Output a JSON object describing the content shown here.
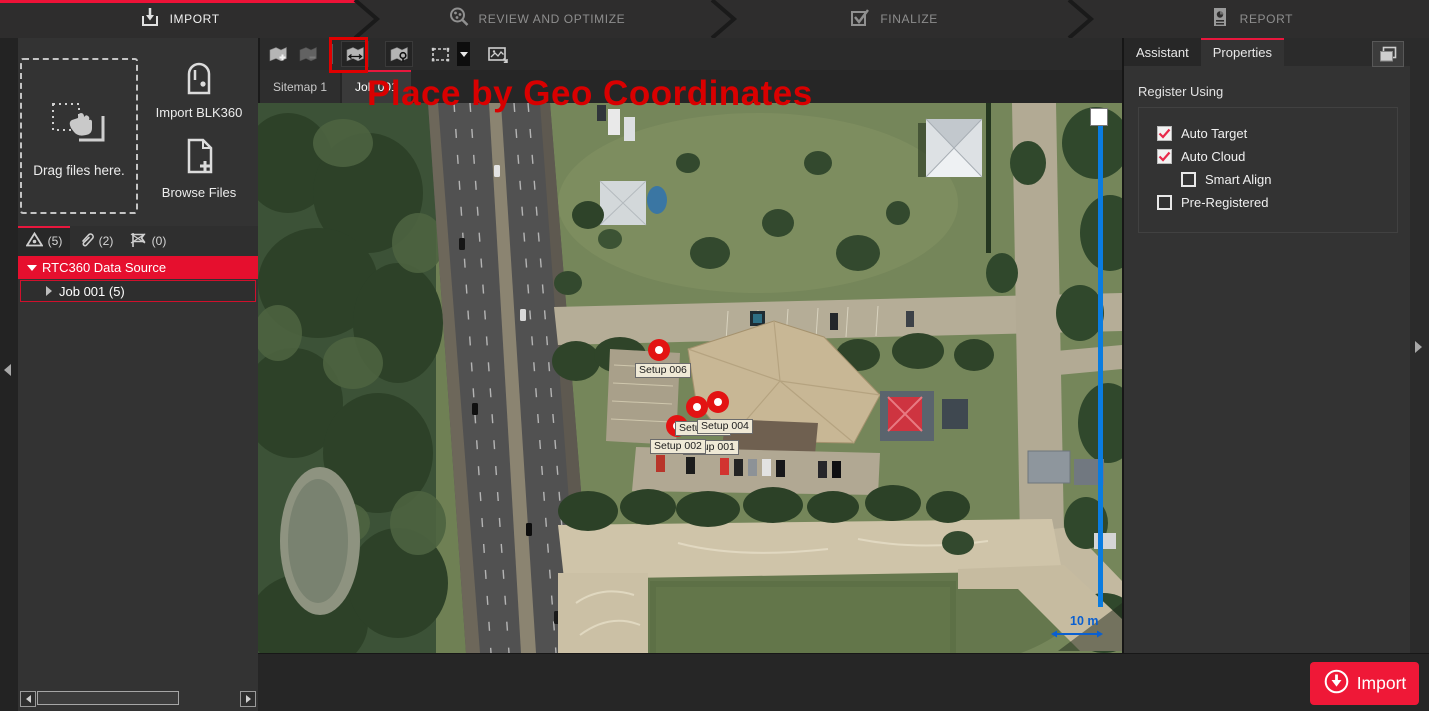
{
  "colors": {
    "accent_red": "#e8173d",
    "annotation_red": "#d90000",
    "slider_blue": "#0a7ce0",
    "tree_selected_red": "#e60f2e"
  },
  "workflow": {
    "steps": [
      {
        "label": "IMPORT",
        "icon": "import-tray-arrow-icon",
        "active": true
      },
      {
        "label": "REVIEW AND OPTIMIZE",
        "icon": "review-magnifier-icon",
        "active": false
      },
      {
        "label": "FINALIZE",
        "icon": "finalize-checkbox-icon",
        "active": false
      },
      {
        "label": "REPORT",
        "icon": "report-document-icon",
        "active": false
      }
    ]
  },
  "left_panel": {
    "dropzone": {
      "label": "Drag files here.",
      "icon": "drag-hand-icon"
    },
    "import_blk360": {
      "label": "Import BLK360",
      "icon": "blk360-scanner-icon"
    },
    "browse_files": {
      "label": "Browse Files",
      "icon": "file-add-icon"
    },
    "browser_tabs": [
      {
        "icon": "setups-triangle-icon",
        "count": "(5)",
        "active": true
      },
      {
        "icon": "links-paperclip-icon",
        "count": "(2)",
        "active": false
      },
      {
        "icon": "flagged-flag-icon",
        "count": "(0)",
        "active": false
      }
    ],
    "tree": {
      "root_label": "RTC360 Data Source",
      "child_label": "Job 001 (5)"
    }
  },
  "toolbar": {
    "buttons": [
      {
        "name": "add-sitemap",
        "icon": "map-add-icon",
        "enabled": true
      },
      {
        "name": "remove-sitemap",
        "icon": "map-remove-icon",
        "enabled": false
      },
      {
        "name": "scale-sitemap",
        "icon": "map-scale-icon",
        "enabled": true
      },
      {
        "name": "place-by-geo-coordinates",
        "icon": "map-geo-pin-icon",
        "enabled": true,
        "highlighted": true
      },
      {
        "name": "fence-select",
        "icon": "fence-selection-icon",
        "enabled": true,
        "has_dropdown": true
      },
      {
        "name": "capture-image",
        "icon": "image-capture-icon",
        "enabled": true
      }
    ]
  },
  "sitemap_tabs": [
    {
      "label": "Sitemap 1",
      "active": false
    },
    {
      "label": "Job 001",
      "active": true
    }
  ],
  "annotation": {
    "text": "Place by Geo Coordinates"
  },
  "map": {
    "setups": [
      {
        "label": "Setup 006"
      },
      {
        "label": "Setup 004"
      },
      {
        "label": "Setup 003"
      },
      {
        "label": "Setup 002"
      },
      {
        "label": "Setup 001"
      }
    ],
    "scale_label": "10 m"
  },
  "right_panel": {
    "tabs": [
      {
        "label": "Assistant",
        "active": false
      },
      {
        "label": "Properties",
        "active": true
      }
    ],
    "section_title": "Register Using",
    "options": [
      {
        "label": "Auto Target",
        "checked": true,
        "indent": 0
      },
      {
        "label": "Auto Cloud",
        "checked": true,
        "indent": 0
      },
      {
        "label": "Smart Align",
        "checked": false,
        "indent": 1
      },
      {
        "label": "Pre-Registered",
        "checked": false,
        "indent": 0
      }
    ]
  },
  "footer": {
    "import_label": "Import"
  }
}
